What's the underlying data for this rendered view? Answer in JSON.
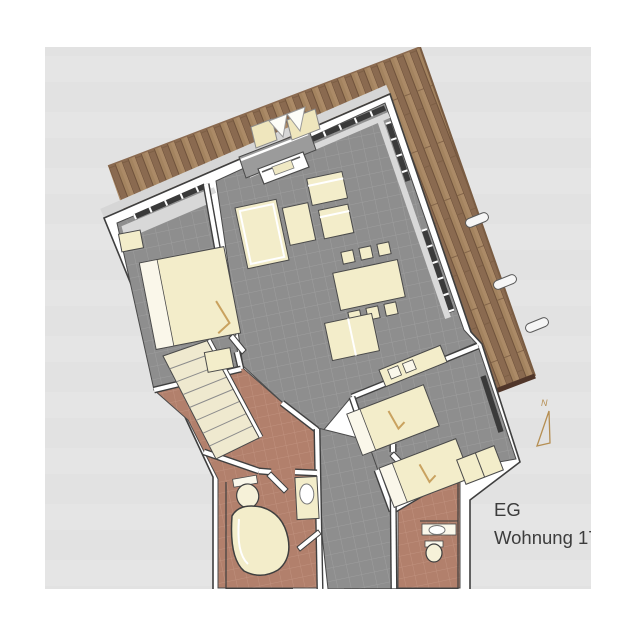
{
  "label_block": {
    "line1": "EG",
    "line2": "Wohnung 17"
  },
  "compass": {
    "label": "N"
  },
  "colors": {
    "page_bg": "#ffffff",
    "canvas_bg": "#e2e2e2",
    "canvas_band": "#e8e8e8",
    "deck_wood_base": "#9c7c5e",
    "deck_wood_light": "#a3835f",
    "deck_wood_dark": "#8a6a50",
    "deck_seam": "#6b4e38",
    "deck_edge_dark": "#50362a",
    "wall_fill": "#ffffff",
    "wall_outline": "#3f3f3f",
    "plinth_gray": "#d6d6d6",
    "tile_gray": "#8e8e8e",
    "tile_gray_grout": "#9e9e9e",
    "tile_terracotta": "#b2806c",
    "tile_terracotta_grout": "#c0917e",
    "furniture_cream": "#f3edca",
    "glass_dark": "#3a3a3a",
    "wardrobe_gray": "#d8d8d8",
    "vestibule_gray": "#9b9b9b",
    "compass_tan": "#b58e52",
    "label_text": "#3c3c3c"
  }
}
